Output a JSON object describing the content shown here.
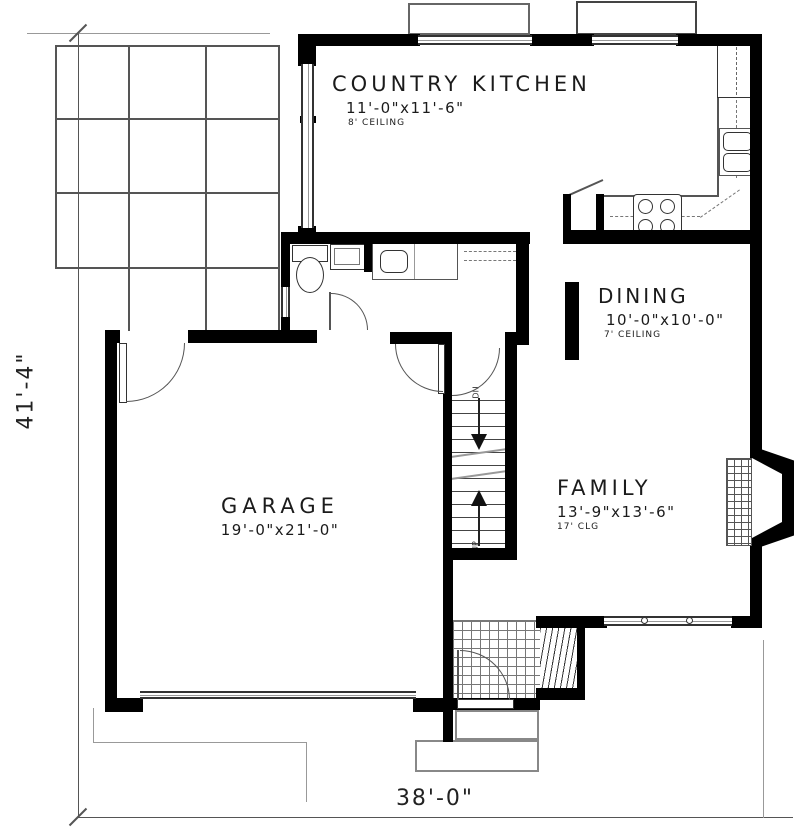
{
  "rooms": {
    "kitchen": {
      "name": "COUNTRY KITCHEN",
      "dims": "11'-0\"x11'-6\"",
      "ceiling": "8' CEILING"
    },
    "dining": {
      "name": "DINING",
      "dims": "10'-0\"x10'-0\"",
      "ceiling": "7' CEILING"
    },
    "family": {
      "name": "FAMILY",
      "dims": "13'-9\"x13'-6\"",
      "ceiling": "17' CLG"
    },
    "garage": {
      "name": "GARAGE",
      "dims": "19'-0\"x21'-0\""
    }
  },
  "dimensions": {
    "overall_width": "38'-0\"",
    "overall_height": "41'-4\""
  },
  "stairs": {
    "down_label": "DN",
    "up_label": "UP"
  },
  "colors": {
    "wall": "#000000",
    "line": "#555555",
    "background": "#ffffff"
  }
}
